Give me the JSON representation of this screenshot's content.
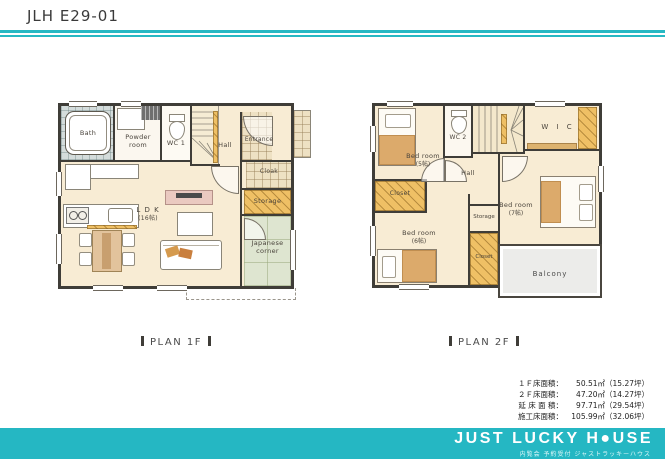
{
  "header": {
    "title": "JLH E29-01"
  },
  "plan1f": {
    "caption": "PLAN 1F",
    "rooms": {
      "bath": "Bath",
      "powder_room": "Powder\nroom",
      "wc": "WC 1",
      "hall": "Hall",
      "entrance": "Entrance",
      "cloak": "Cloak",
      "storage": "Storage",
      "ldk": "L D K",
      "ldk_size": "(16帖)",
      "japanese_corner": "Japanese\ncorner"
    }
  },
  "plan2f": {
    "caption": "PLAN 2F",
    "rooms": {
      "bedroom5": "Bed room",
      "bedroom5_size": "(5帖)",
      "wc": "WC 2",
      "wic": "W I C",
      "hall": "Hall",
      "closet_left": "Closet",
      "bedroom6": "Bed room",
      "bedroom6_size": "(6帖)",
      "storage": "Storage",
      "closet_center": "Closet",
      "bedroom7": "Bed room",
      "bedroom7_size": "(7帖)",
      "balcony": "Balcony"
    }
  },
  "areas": {
    "rows": [
      {
        "label": "１Ｆ床面積：",
        "value": "50.51㎡（15.27坪）"
      },
      {
        "label": "２Ｆ床面積：",
        "value": "47.20㎡（14.27坪）"
      },
      {
        "label": "延 床 面 積：",
        "value": "97.71㎡（29.54坪）"
      },
      {
        "label": "施工床面積：",
        "value": "105.99㎡（32.06坪）"
      }
    ]
  },
  "footer": {
    "logo": "JUST LUCKY H●USE",
    "tagline": "内覧会 予約受付 ジャストラッキーハウス"
  }
}
